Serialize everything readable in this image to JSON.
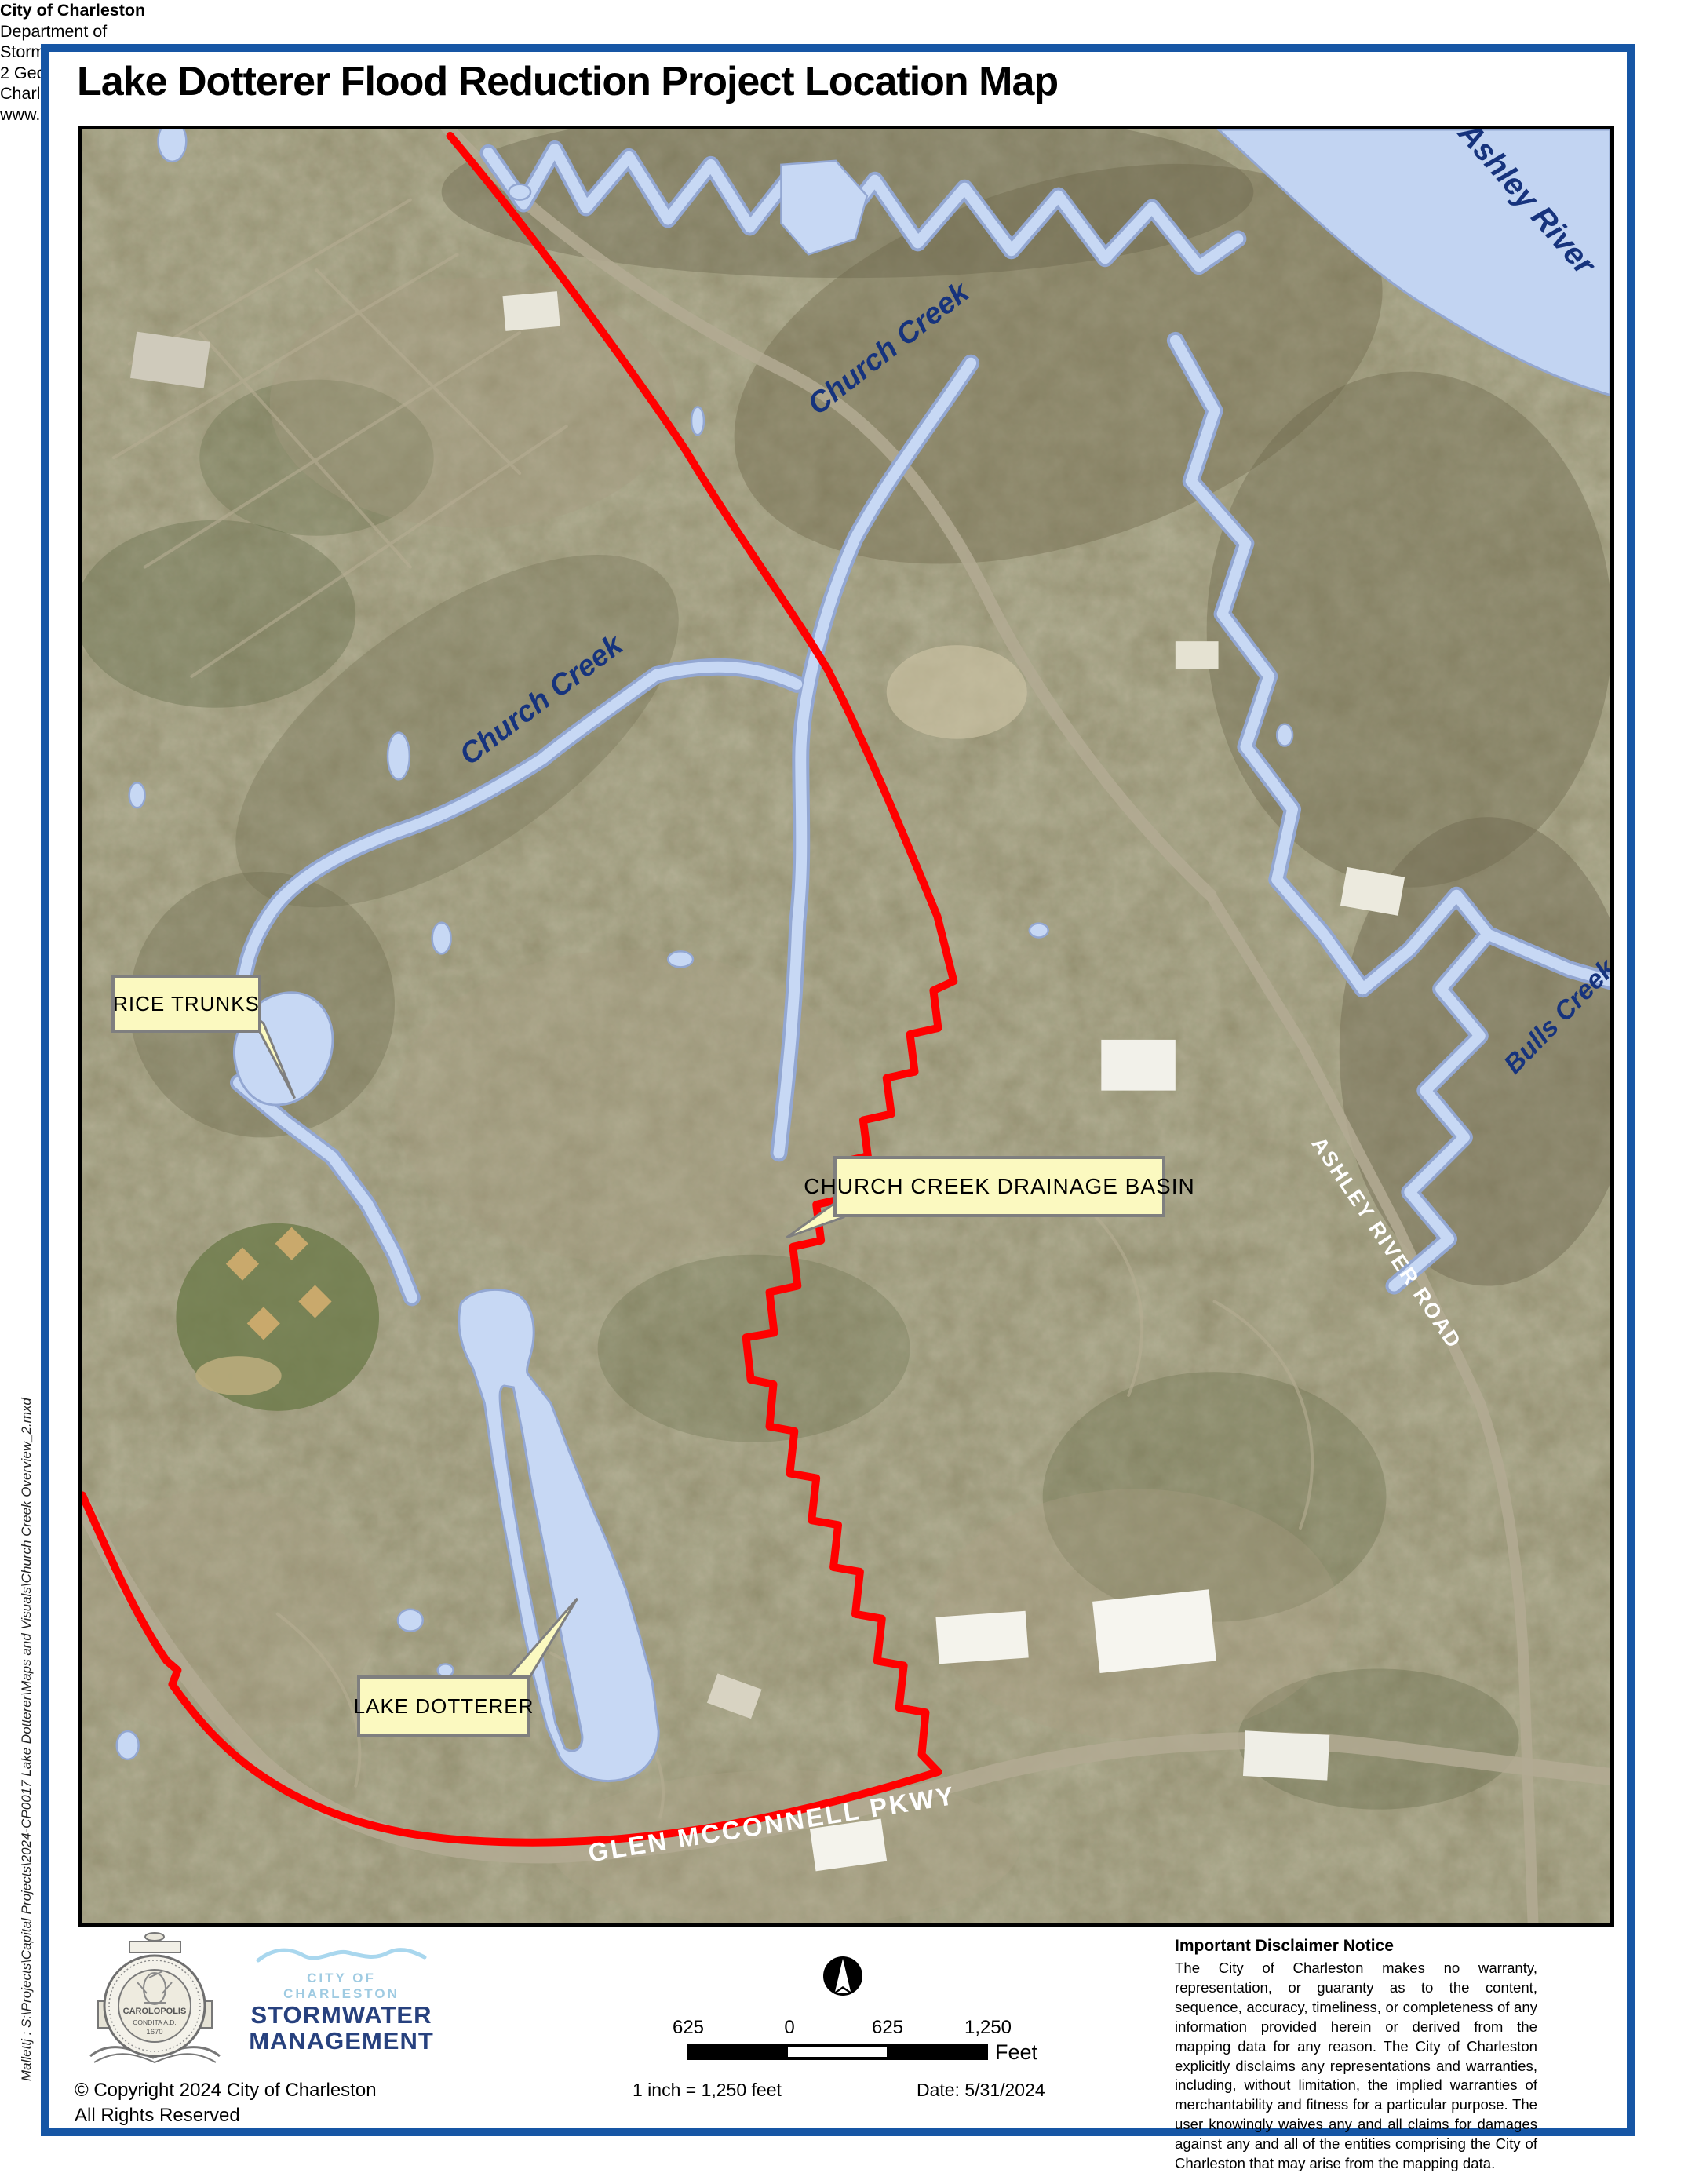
{
  "page": {
    "title": "Lake Dotterer Flood Reduction Project Location Map",
    "file_path": "Mallettj : S:\\Projects\\Capital Projects\\2024-CP0017 Lake Dotterer\\Maps and Visuals\\Church Creek Overview_2.mxd"
  },
  "map": {
    "water_labels": {
      "church_creek_upper": "Church Creek",
      "church_creek_lower": "Church Creek",
      "ashley_river": "Ashley River",
      "bulls_creek": "Bulls Creek"
    },
    "road_labels": {
      "ashley_river_road": "ASHLEY RIVER ROAD",
      "glen_mcconnell_pkwy": "GLEN MCCONNELL PKWY"
    },
    "callouts": {
      "rice_trunks": "RICE TRUNKS",
      "drainage_basin": "CHURCH CREEK DRAINAGE BASIN",
      "lake_dotterer": "LAKE DOTTERER"
    },
    "colors": {
      "boundary": "#ff0000",
      "water_fill": "#c7d8f4",
      "water_outline": "#93a7d2",
      "water_label": "#16337d",
      "callout_bg": "#fbf9c0",
      "callout_border": "#7f7f7f",
      "page_border": "#1656a5"
    }
  },
  "footer": {
    "seal": {
      "name": "CAROLOPOLIS",
      "condita": "CONDITA A.D.",
      "year": "1670"
    },
    "brand": {
      "city": "CITY OF CHARLESTON",
      "line1": "STORMWATER",
      "line2": "MANAGEMENT"
    },
    "copyright_line1": "© Copyright 2024 City of Charleston",
    "copyright_line2": "All Rights Reserved",
    "address": [
      "City of Charleston",
      "Department of",
      "Stormwater Management",
      "2 George St, Suite 2100",
      "Charleston, SC  29401",
      "www.charleston-sc.gov"
    ],
    "scale": {
      "left": "625",
      "zero": "0",
      "mid": "625",
      "right": "1,250",
      "unit": "Feet",
      "ratio": "1 inch = 1,250 feet",
      "date": "Date: 5/31/2024"
    },
    "disclaimer": {
      "title": "Important Disclaimer Notice",
      "body": "The City of Charleston makes no warranty, representation, or guaranty as to the content, sequence, accuracy, timeliness, or completeness of any information provided herein or derived from the mapping data for any reason. The City of Charleston explicitly disclaims any representations and warranties, including, without limitation, the implied warranties of merchantability and fitness for a particular purpose. The user knowingly waives any and all claims for damages against any and all of the entities comprising the City of Charleston that may arise from the mapping data."
    }
  }
}
